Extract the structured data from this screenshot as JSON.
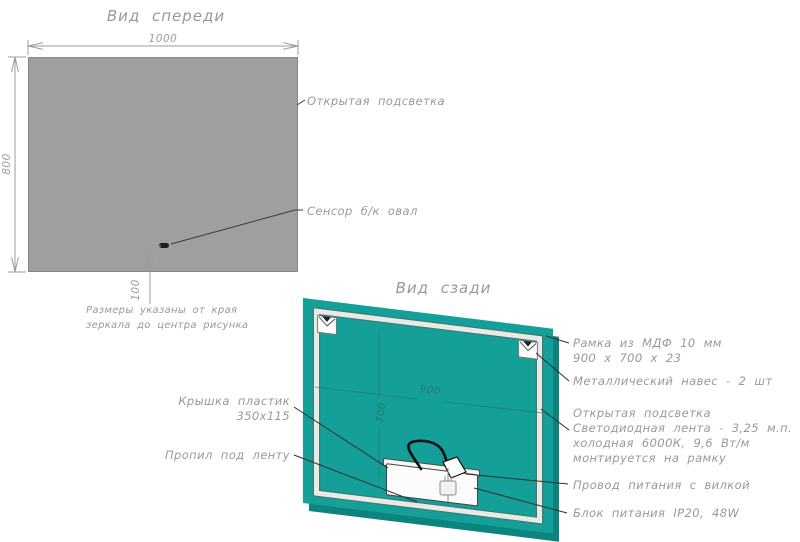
{
  "colors": {
    "mirror": "#9f9fa0",
    "panel": "#149f99",
    "panel_edge": "#0d837d",
    "label": "#999999",
    "dimline": "#9c9c9c",
    "leader": "#2e2e2e",
    "frameband": "#e9eae6",
    "frameline": "#3f7b76"
  },
  "front": {
    "title": "Вид спереди",
    "dims": {
      "width": "1000",
      "height": "800",
      "sensor_offset": "100"
    },
    "labels": {
      "backlight": "Открытая подсветка",
      "sensor": "Сенсор б/к овал"
    },
    "note": [
      "Размеры указаны от края",
      "зеркала до центра рисунка"
    ]
  },
  "back": {
    "title": "Вид сзади",
    "dims": {
      "inner_width": "900",
      "inner_height": "700"
    },
    "labels": {
      "frame_line1": "Рамка из МДФ 10 мм",
      "frame_line2": "900 х 700 х 23",
      "hanger": "Металлический навес - 2 шт",
      "backlight_line1": "Открытая подсветка",
      "backlight_line2": "Светодиодная лента - 3,25 м.п.",
      "backlight_line3": "холодная 6000К, 9,6 Вт/м",
      "backlight_line4": "монтируется на рамку",
      "cord": "Провод питания с вилкой",
      "psu": "Блок питания IP20, 48W",
      "cover_line1": "Крышка пластик",
      "cover_line2": "350х115",
      "cut": "Пропил под ленту"
    }
  }
}
